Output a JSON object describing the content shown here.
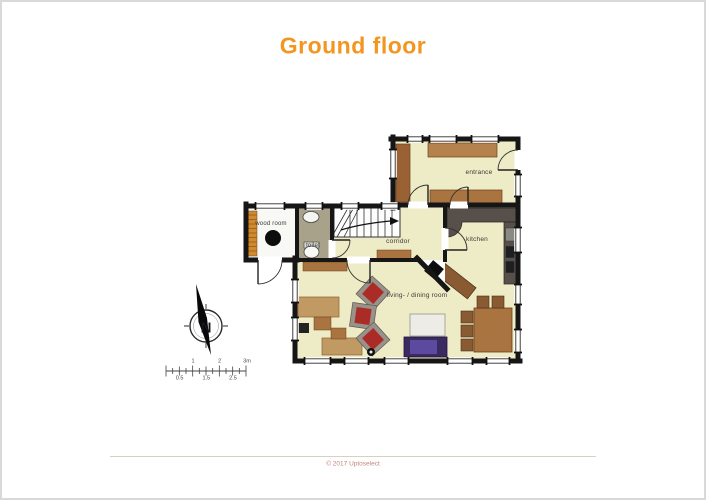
{
  "page": {
    "title": "Ground floor",
    "title_color": "#f2961f",
    "copyright": "© 2017 Uptoselect",
    "copyright_color": "#c2837a"
  },
  "floor_plan": {
    "rooms": [
      {
        "id": "entrance",
        "label": "entrance"
      },
      {
        "id": "wood_room",
        "label": "wood room"
      },
      {
        "id": "toilet",
        "label": "toilet"
      },
      {
        "id": "corridor",
        "label": "corridor"
      },
      {
        "id": "kitchen",
        "label": "kitchen"
      },
      {
        "id": "living_dining",
        "label": "living- / dining room"
      }
    ],
    "colors": {
      "walls": "#161616",
      "floor": "#eeecc6",
      "wood_room_floor": "#f8f8f5",
      "toilet_floor": "#a8a28a",
      "stairs": "#fdfdfd",
      "furniture_brown": "#a9743f",
      "furniture_tan": "#c09a62",
      "armchair_red": "#ab2c26",
      "armchair_frame": "#98928a",
      "sofa_purple": "#3a2a60",
      "sofa_inner": "#5c49a0",
      "counter_dark": "#57504a",
      "coffee_table": "#edece6"
    }
  },
  "compass": {
    "label": "N"
  },
  "scale_bar": {
    "top_labels": [
      "1",
      "2",
      "3m"
    ],
    "bottom_labels": [
      "0.5",
      "1.5",
      "2.5"
    ]
  }
}
